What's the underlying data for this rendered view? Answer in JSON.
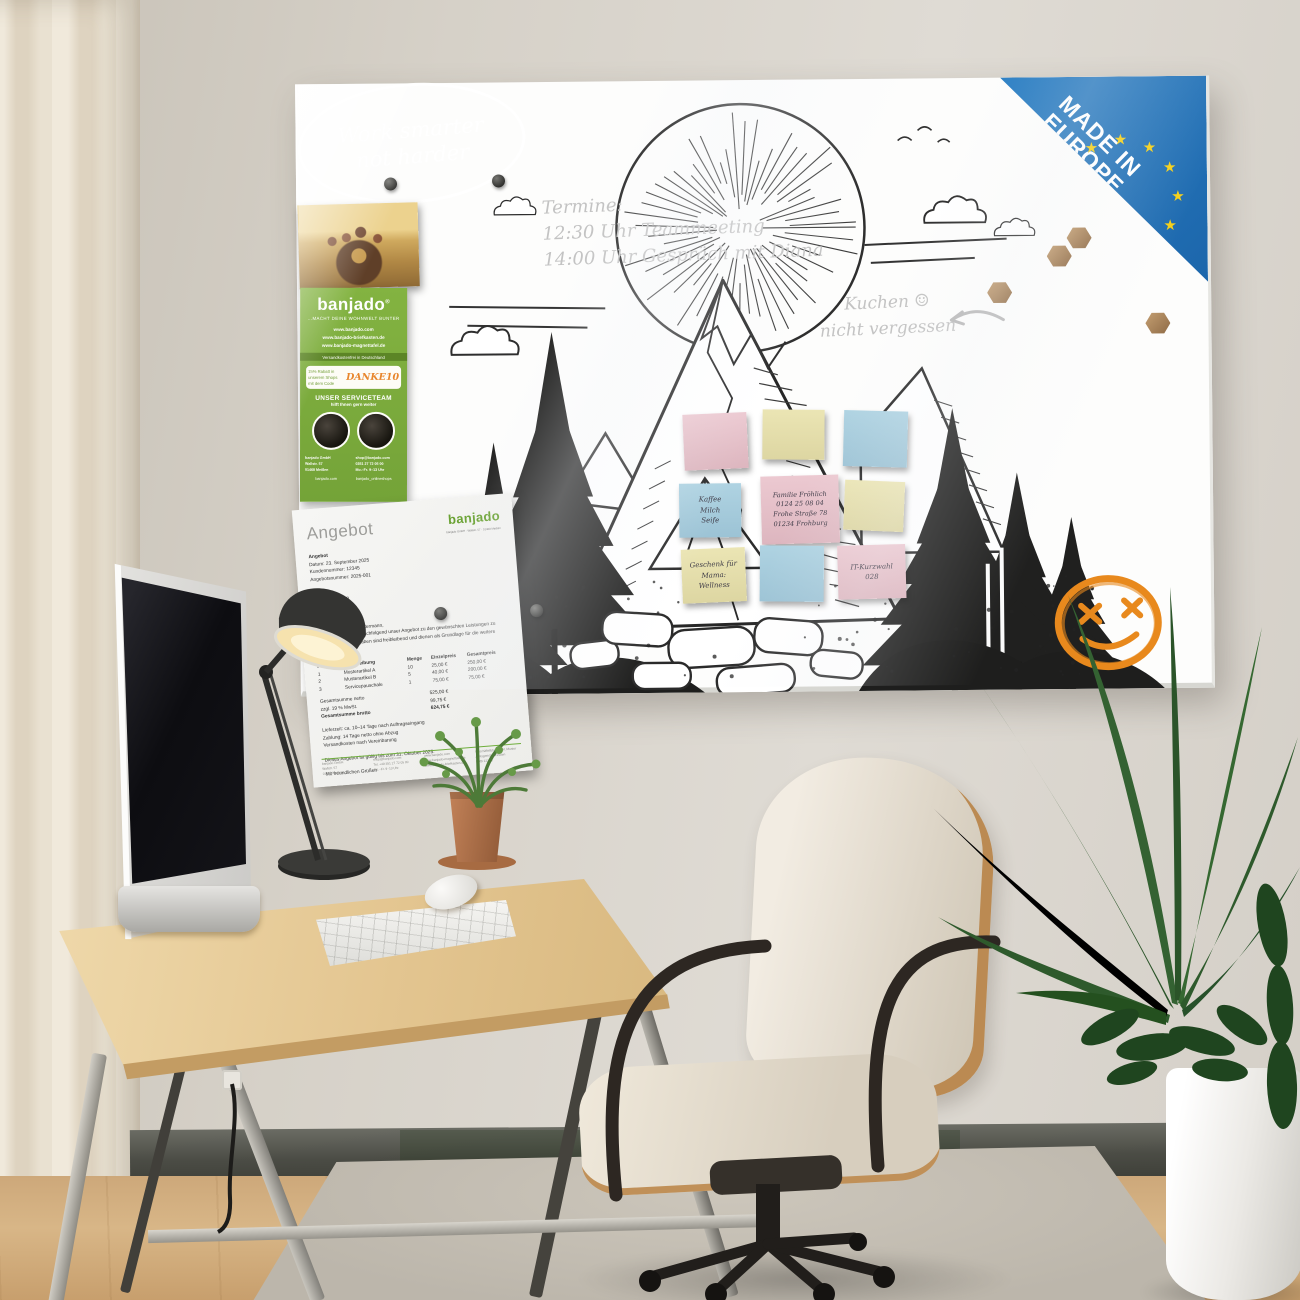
{
  "colors": {
    "accent_green": "#76a93d",
    "eu_blue": "#1e6fbf",
    "eu_star_yellow": "#f5d018",
    "doodle_orange": "#e8891d",
    "note_pink": "#e4bfc7",
    "note_yellow": "#e6e0ad",
    "note_blue": "#a6cbdc"
  },
  "icons": {
    "star": "★",
    "smiley": "☺"
  },
  "board": {
    "badge": {
      "line1": "MADE IN",
      "line2": "EUROPE"
    },
    "handwriting": {
      "termine_title": "Termine:",
      "termine_line1": "12:30 Uhr Teammeeting",
      "termine_line2": "14:00 Uhr Gespräch mit Diana",
      "kuchen_line1": "Kuchen",
      "kuchen_line2": "nicht vergessen",
      "motto_line1": "Work smarter",
      "motto_line2": "not harder"
    },
    "brochure": {
      "logo": "banjado",
      "logo_reg": "®",
      "tagline": "...MACHT DEINE WOHNWELT BUNTER",
      "url1": "www.banjado.com",
      "url2": "www.banjado-briefkasten.de",
      "url3": "www.banjado-magnettafel.de",
      "shipping": "Versandkostenfrei in Deutschland",
      "discount_text": "15% Rabatt in unserem Shops mit dem Code",
      "discount_code": "DANKE10",
      "service_title": "UNSER SERVICETEAM",
      "service_sub": "hilft Ihnen gern weiter",
      "contact_left": [
        "banjado GmbH",
        "Wallstr. 57",
        "01468 Meißen"
      ],
      "contact_right": [
        "shop@banjado.com",
        "0351 27 72 05 00",
        "Mo.–Fr. 9–13 Uhr"
      ],
      "social1": "banjado.com",
      "social2": "banjado_onlineshops"
    },
    "sticky_notes": [
      {
        "color": "pink",
        "lines": []
      },
      {
        "color": "yellow",
        "lines": []
      },
      {
        "color": "blue",
        "lines": []
      },
      {
        "color": "blue",
        "lines": [
          "Kaffee",
          "Milch",
          "Seife"
        ]
      },
      {
        "color": "pink",
        "lines": [
          "Familie Fröhlich",
          "0124 25 08 04",
          "Frohe Straße 78",
          "01234 Frohburg"
        ]
      },
      {
        "color": "yellow",
        "lines": []
      },
      {
        "color": "yellow",
        "lines": [
          "Geschenk für",
          "Mama:",
          "Wellness"
        ]
      },
      {
        "color": "blue",
        "lines": []
      },
      {
        "color": "pink",
        "lines": [
          "IT-Kurzwahl",
          "028"
        ]
      }
    ],
    "document": {
      "title": "Angebot",
      "logo": "banjado",
      "logo_sub": "banjado GmbH · Wallstr. 57 · 01468 Meißen",
      "meta": [
        "Angebot",
        "Datum: 23. September 2025",
        "Kundennummer: 12345",
        "Angebotsnummer: 2025-001"
      ],
      "customer": [
        "Kunde",
        "Max Mustermann",
        "Musterstraße 12",
        "01462 Musterstadt"
      ],
      "salutation": "Sehr geehrter Herr Mustermann,",
      "intro": "wir freuen uns, Ihnen nachfolgend unser Angebot zu den gewünschten Leistungen zu unterbreiten. Alle Angaben sind freibleibend und dienen als Grundlage für die weitere Abstimmung.",
      "table": {
        "headers": [
          "Position",
          "Beschreibung",
          "Menge",
          "Einzelpreis",
          "Gesamtpreis"
        ],
        "rows": [
          [
            "1",
            "Musterartikel A",
            "10",
            "25,00 €",
            "250,00 €"
          ],
          [
            "2",
            "Musterartikel B",
            "5",
            "40,00 €",
            "200,00 €"
          ],
          [
            "3",
            "Servicepauschale",
            "1",
            "75,00 €",
            "75,00 €"
          ]
        ],
        "totals": [
          {
            "label": "Gesamtsumme netto",
            "value": "525,00 €"
          },
          {
            "label": "zzgl. 19 % MwSt.",
            "value": "99,75 €"
          },
          {
            "label": "Gesamtsumme brutto",
            "value": "624,75 €"
          }
        ]
      },
      "terms": [
        "Lieferzeit: ca. 10–14 Tage nach Auftragseingang",
        "Zahlung: 14 Tage netto ohne Abzug",
        "Versandkosten nach Vereinbarung"
      ],
      "validity": "Dieses Angebot ist gültig bis zum 31. Oktober 2025.",
      "closing": "Mit freundlichen Grüßen",
      "footer": [
        [
          "banjado GmbH",
          "Wallstr. 57",
          "01468 Meißen"
        ],
        [
          "shop@banjado.com",
          "Tel. +49 351 27 72 05 00",
          "Mo.–Fr. 9–13 Uhr"
        ],
        [
          "www.banjado.com",
          "www.banjado-magnettafel.de",
          "www.banjado-briefkasten.de"
        ],
        [
          "Geschäftsführung: M. Muster",
          "Amtsgericht Dresden",
          "HRB 12345"
        ]
      ]
    }
  }
}
